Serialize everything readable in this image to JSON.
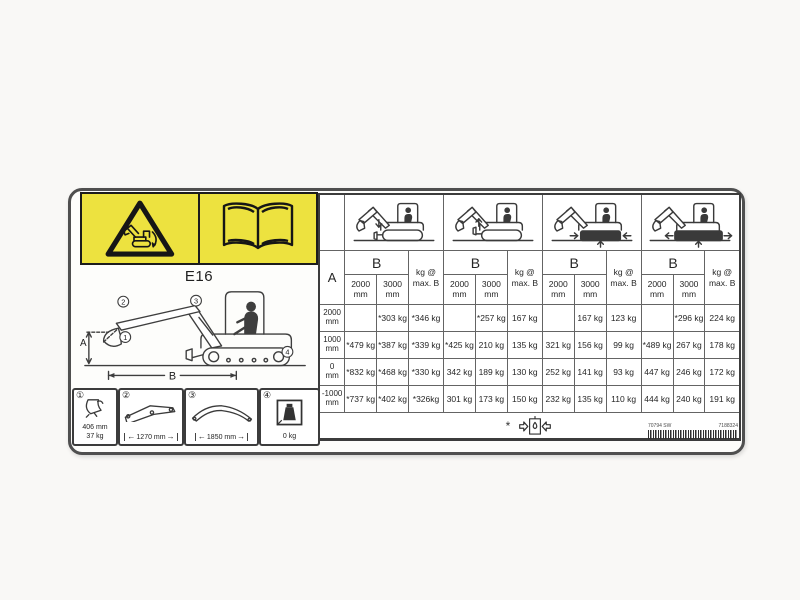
{
  "page": {
    "model": "E16"
  },
  "banner": {
    "warning_icon": "tip-over-warning-icon",
    "manual_icon": "read-manual-book-icon"
  },
  "diagram": {
    "dim_a": "A",
    "dim_b": "B",
    "callouts": [
      "1",
      "2",
      "3",
      "4"
    ]
  },
  "spec_boxes": [
    {
      "number": "①",
      "lines": [
        "406 mm",
        "37 kg"
      ]
    },
    {
      "number": "②",
      "dim": "1270 mm"
    },
    {
      "number": "③",
      "dim": "1850 mm"
    },
    {
      "number": "④",
      "dim": "0 kg"
    }
  ],
  "table": {
    "corner_label": "A",
    "b_label": "B",
    "kg_label": "kg @\nmax. B",
    "sub_labels": [
      "2000\nmm",
      "3000\nmm"
    ],
    "row_labels": [
      "2000\nmm",
      "1000\nmm",
      "0\nmm",
      "-1000\nmm"
    ],
    "groups": [
      {
        "icon": "excavator-blade-down-icon",
        "rows": [
          [
            "",
            "*303 kg",
            "*346 kg"
          ],
          [
            "*479 kg",
            "*387 kg",
            "*339 kg"
          ],
          [
            "*832 kg",
            "*468 kg",
            "*330 kg"
          ],
          [
            "*737 kg",
            "*402 kg",
            "*326kg"
          ]
        ]
      },
      {
        "icon": "excavator-blade-up-icon",
        "rows": [
          [
            "",
            "*257 kg",
            "167 kg"
          ],
          [
            "*425 kg",
            "210 kg",
            "135 kg"
          ],
          [
            "342 kg",
            "189 kg",
            "130 kg"
          ],
          [
            "301 kg",
            "173 kg",
            "150 kg"
          ]
        ]
      },
      {
        "icon": "excavator-tracks-retracted-icon",
        "rows": [
          [
            "",
            "167 kg",
            "123 kg"
          ],
          [
            "321 kg",
            "156 kg",
            "99 kg"
          ],
          [
            "252 kg",
            "141 kg",
            "93 kg"
          ],
          [
            "232 kg",
            "135 kg",
            "110 kg"
          ]
        ]
      },
      {
        "icon": "excavator-tracks-extended-icon",
        "rows": [
          [
            "",
            "*296 kg",
            "224 kg"
          ],
          [
            "*489 kg",
            "267 kg",
            "178 kg"
          ],
          [
            "447 kg",
            "246 kg",
            "172 kg"
          ],
          [
            "444 kg",
            "240 kg",
            "191 kg"
          ]
        ]
      }
    ],
    "footnote": {
      "symbol": "*",
      "icon": "hydraulic-capacity-limit-icon"
    }
  },
  "footer": {
    "part_number_left": "70794 SW",
    "part_number_right": "7188324"
  },
  "colors": {
    "banner_yellow": "#ede23f",
    "label_background": "#fdfdfb",
    "line_dark": "#3c3c3c",
    "text": "#262626"
  }
}
